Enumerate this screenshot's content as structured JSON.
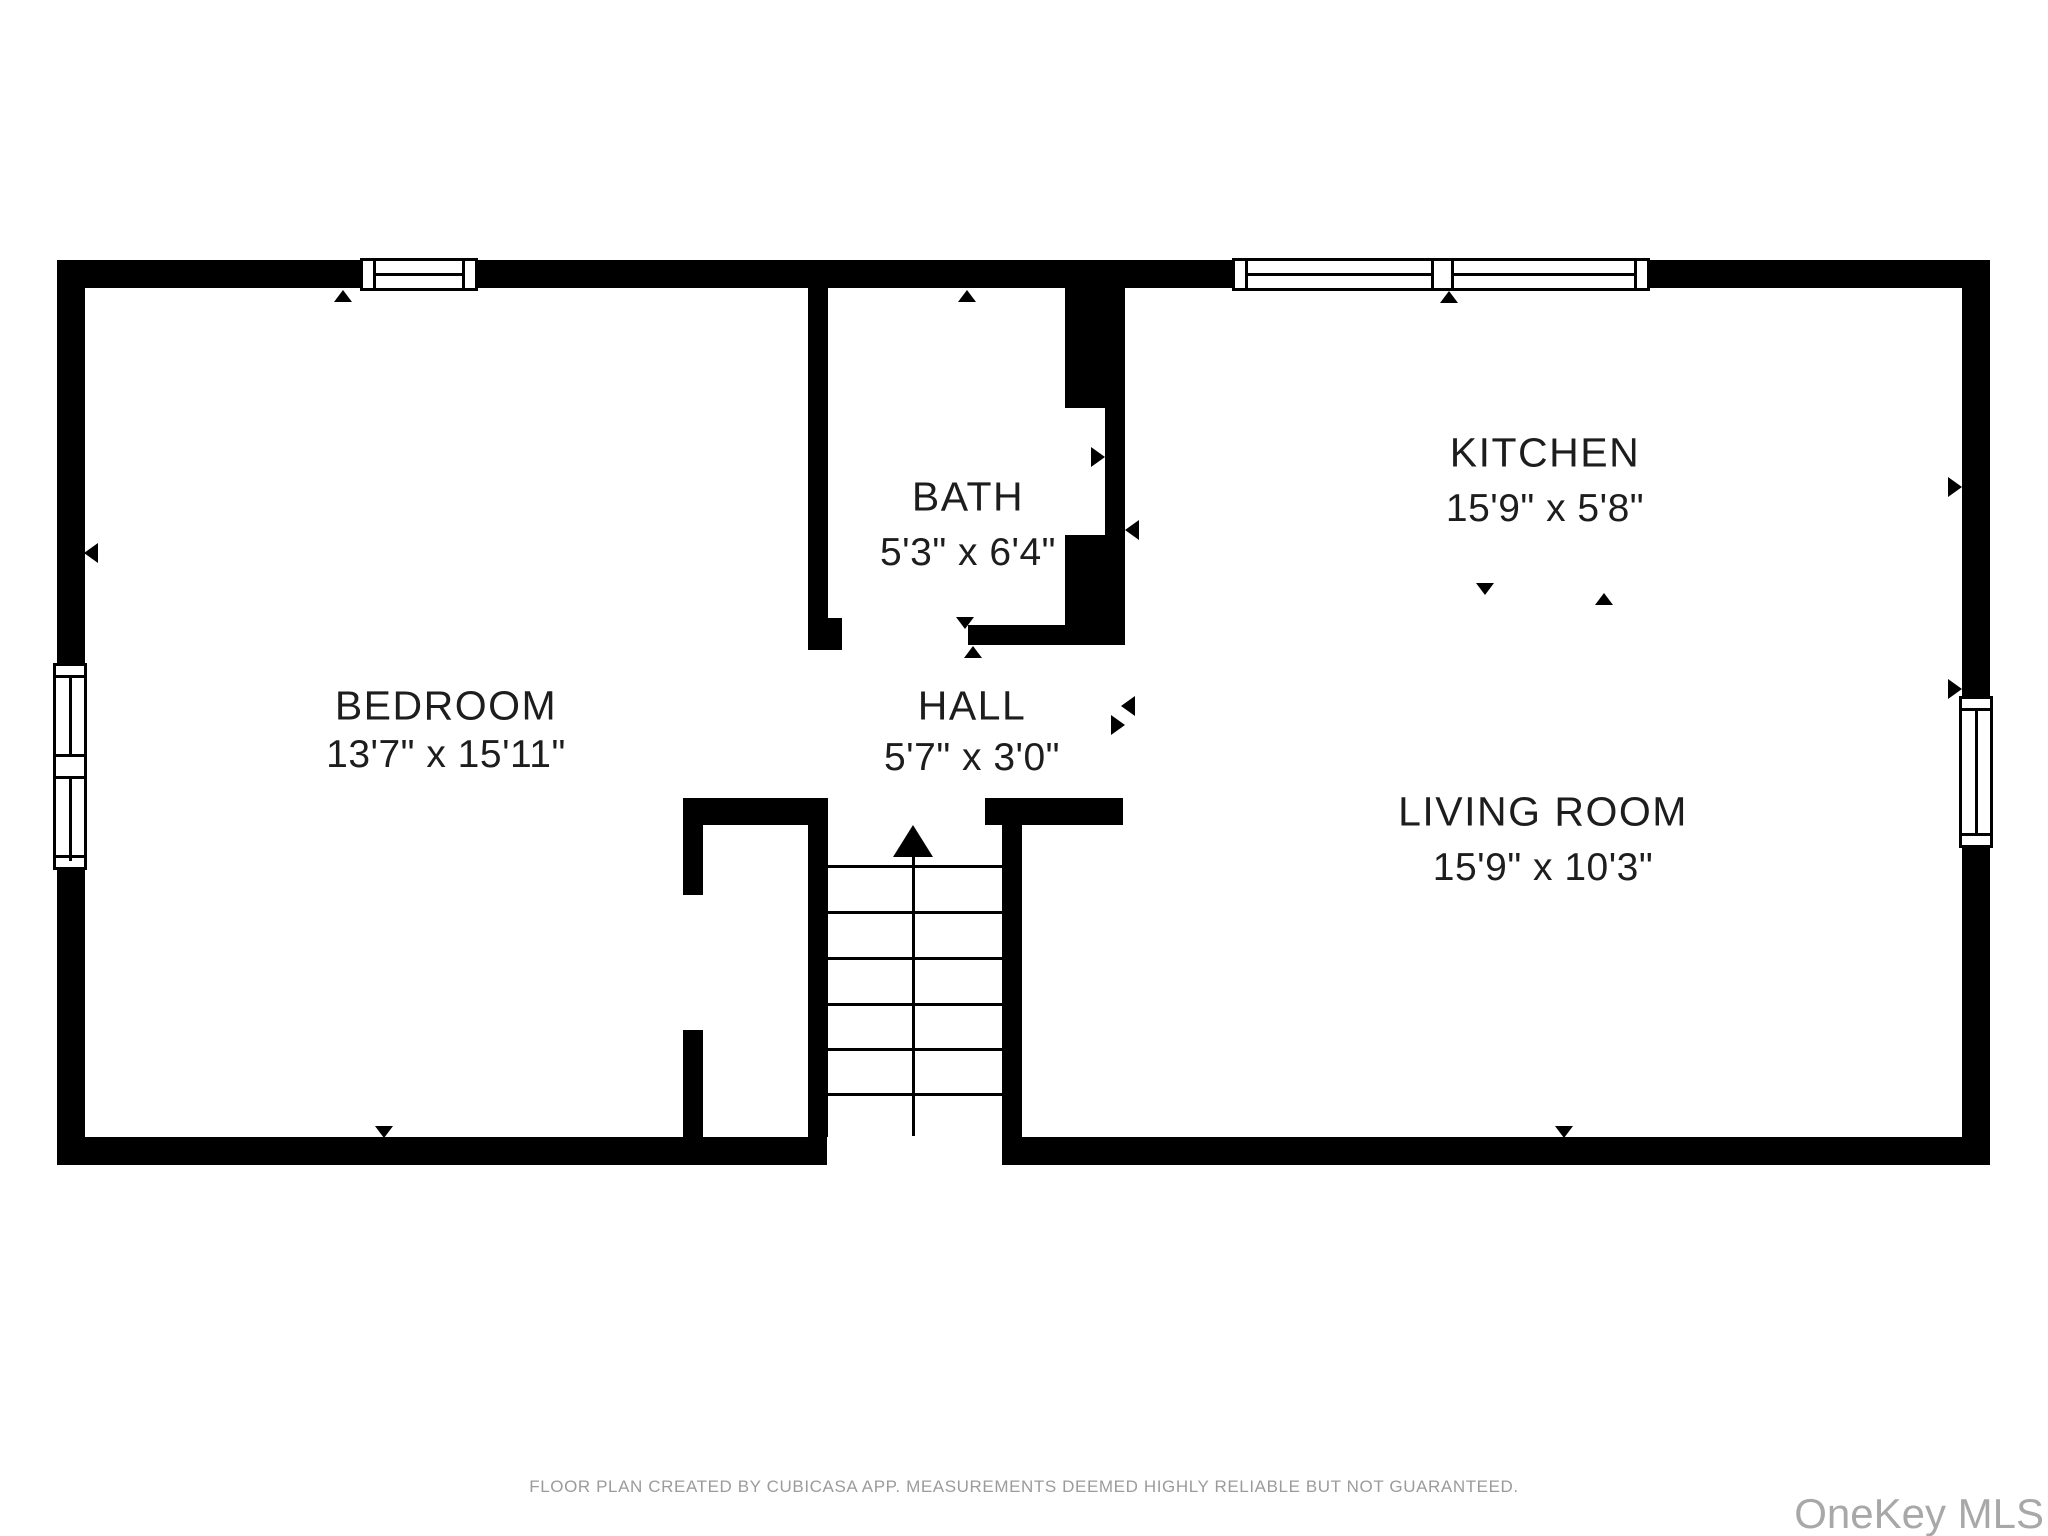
{
  "plan": {
    "rooms": [
      {
        "id": "bedroom",
        "label": "BEDROOM",
        "dims": "13'7\" x 15'11\""
      },
      {
        "id": "bath",
        "label": "BATH",
        "dims": "5'3\" x 6'4\""
      },
      {
        "id": "hall",
        "label": "HALL",
        "dims": "5'7\" x 3'0\""
      },
      {
        "id": "kitchen",
        "label": "KITCHEN",
        "dims": "15'9\" x 5'8\""
      },
      {
        "id": "living_room",
        "label": "LIVING ROOM",
        "dims": "15'9\" x 10'3\""
      }
    ]
  },
  "footer": {
    "disclaimer": "FLOOR PLAN CREATED BY CUBICASA APP. MEASUREMENTS DEEMED HIGHLY RELIABLE BUT NOT GUARANTEED."
  },
  "watermark": {
    "text": "OneKey MLS"
  },
  "colors": {
    "wall": "#000000",
    "room_text": "#1d1d1d",
    "footer_text": "#9b9b9b",
    "watermark_text": "#a8a8a8",
    "background": "#ffffff"
  }
}
